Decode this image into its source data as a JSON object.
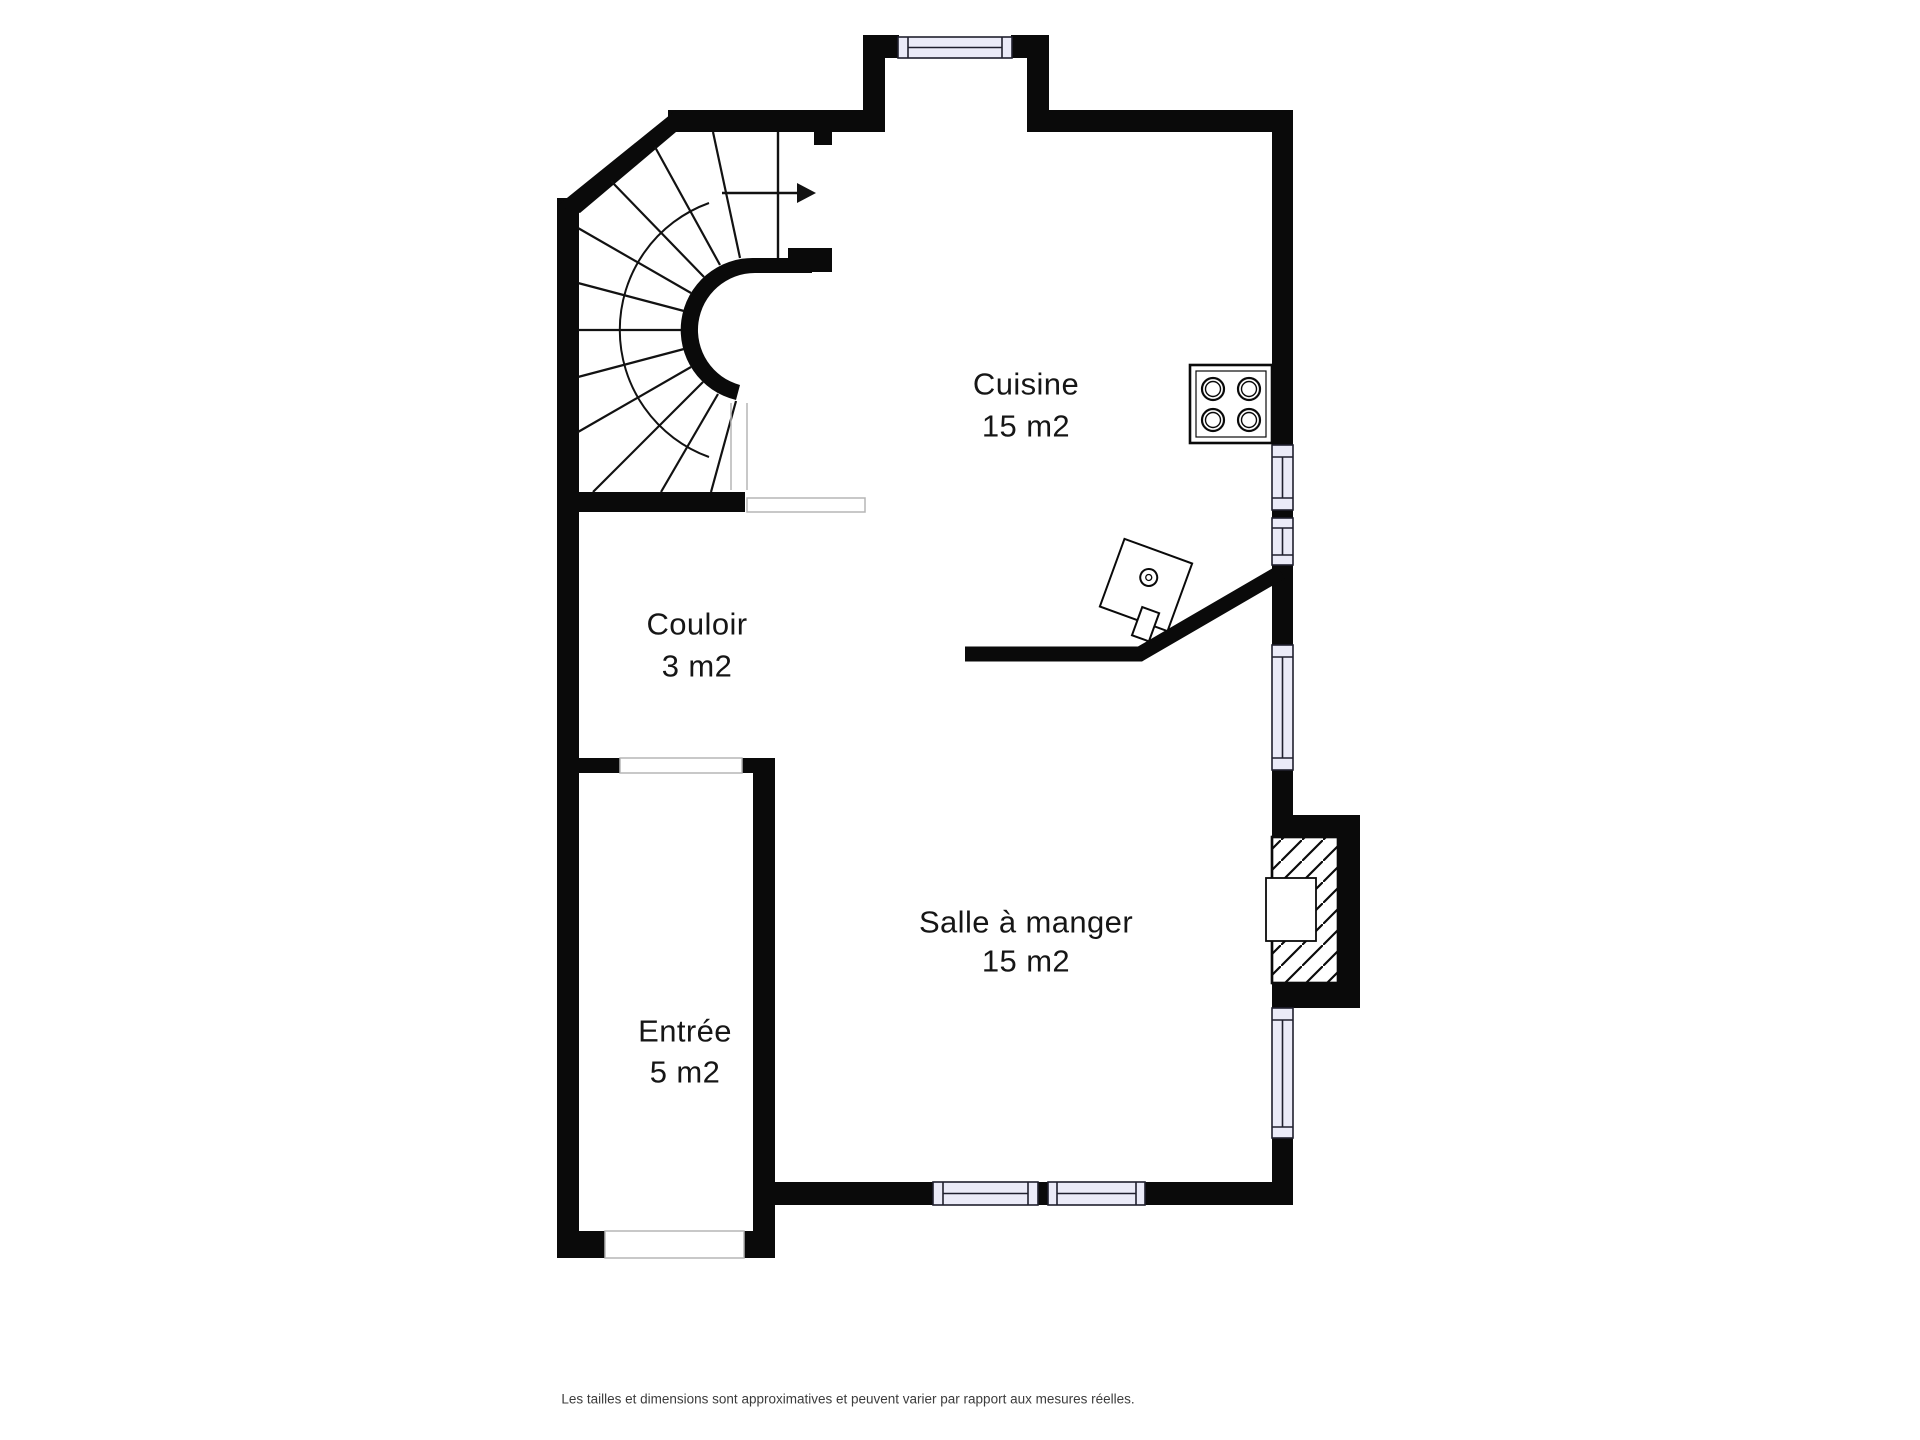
{
  "plan": {
    "rooms": [
      {
        "id": "cuisine",
        "name": "Cuisine",
        "area": "15 m2"
      },
      {
        "id": "couloir",
        "name": "Couloir",
        "area": "3 m2"
      },
      {
        "id": "entree",
        "name": "Entrée",
        "area": "5 m2"
      },
      {
        "id": "salle_a_manger",
        "name": "Salle à manger",
        "area": "15 m2"
      }
    ],
    "fixtures": [
      "spiral-staircase",
      "stair-direction-arrow",
      "stove-4-burners",
      "boiler",
      "fireplace-chimney",
      "windows",
      "door-openings"
    ],
    "colors": {
      "background": "#ffffff",
      "wall": "#0a0a0a",
      "window_fill": "#ebebf8",
      "window_stroke": "#20202e",
      "opening_stroke": "#b5b5b5",
      "label_text": "#161616",
      "footer_text": "#3c3c3c"
    }
  },
  "footer": {
    "disclaimer": "Les tailles et dimensions sont approximatives et peuvent varier par rapport aux mesures réelles."
  }
}
